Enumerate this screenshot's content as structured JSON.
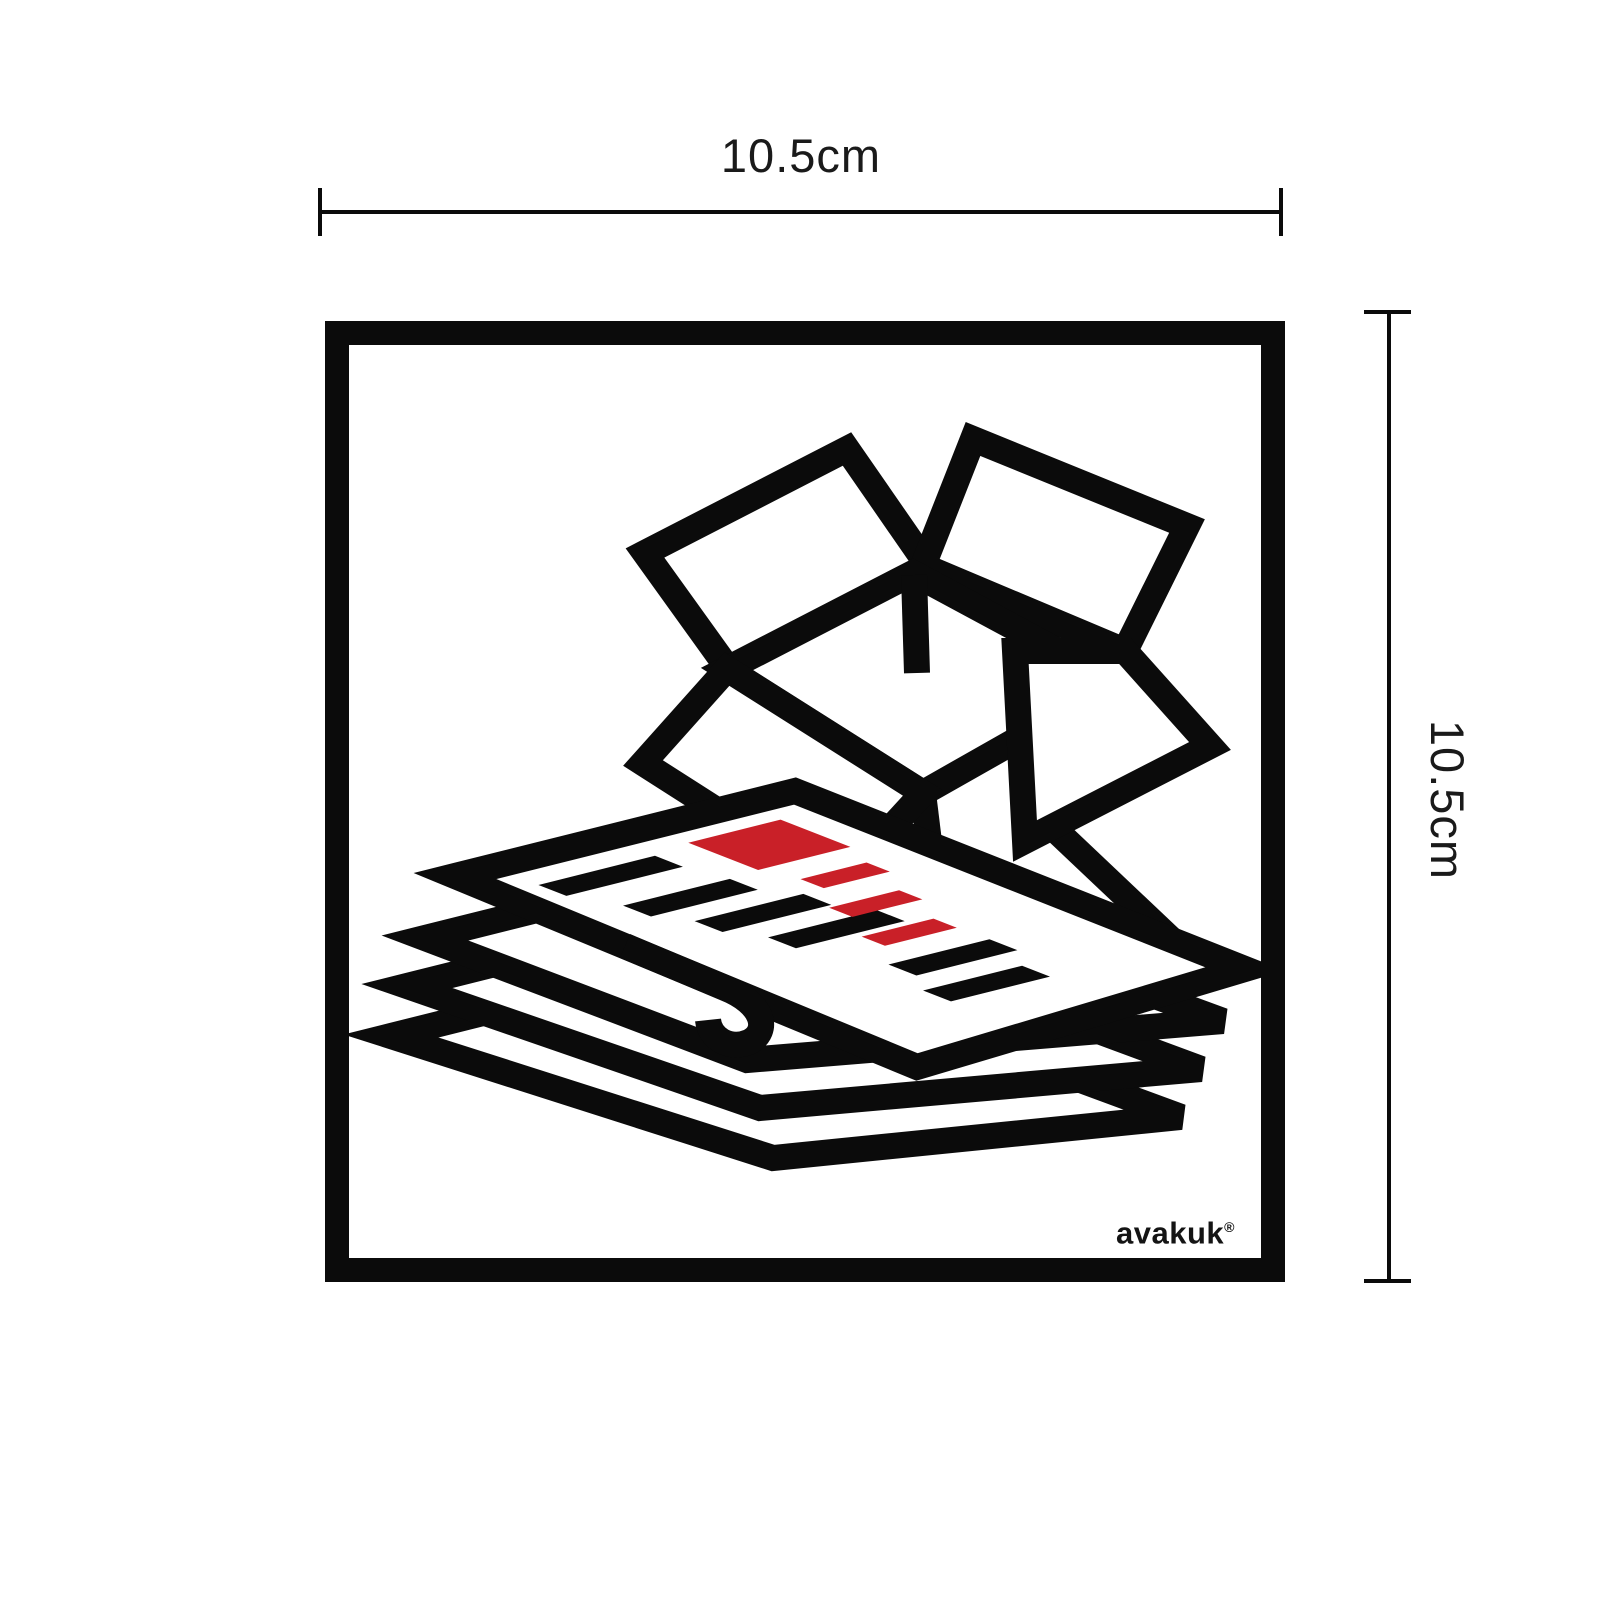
{
  "product": {
    "type": "square recycling sticker",
    "illustration": "open-cardboard-box-with-stack-of-newspapers",
    "colors": {
      "outline": "#0b0b0b",
      "accent_red": "#c92028",
      "background": "#ffffff"
    }
  },
  "dimensions": {
    "top": {
      "label": "10.5cm"
    },
    "right": {
      "label": "10.5cm"
    }
  },
  "brand": {
    "name": "avakuk",
    "mark": "®"
  },
  "icons": {
    "main": "paper-recycling-pictogram"
  }
}
